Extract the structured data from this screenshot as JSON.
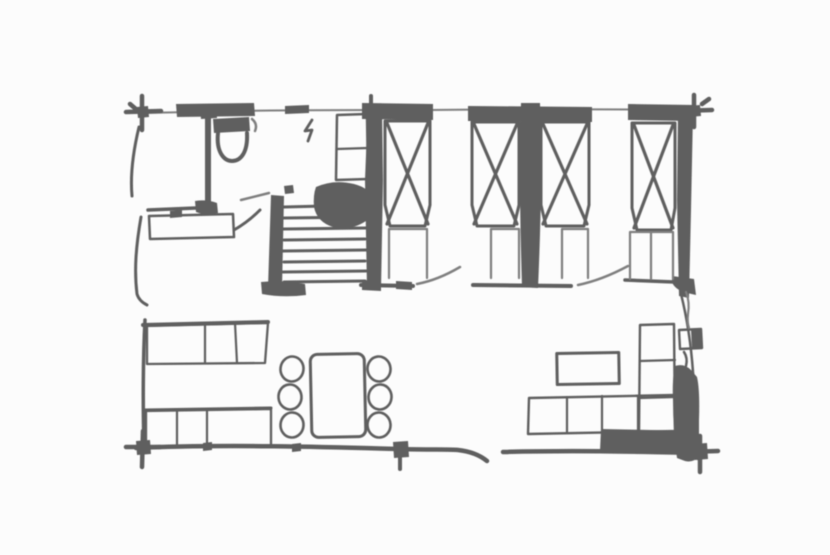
{
  "palette": {
    "ink": "#5e5e5e",
    "ink_lite": "#7f7f7f",
    "paper": "#fcfcfc"
  },
  "canvas": {
    "width": 830,
    "height": 555
  },
  "drawing": {
    "kind": "hand-drawn floor plan sketch",
    "text_labels": [],
    "rooms": [
      {
        "name": "bathroom",
        "position": "top-left"
      },
      {
        "name": "hall-and-stairs",
        "position": "top-center-left"
      },
      {
        "name": "sleeping-area",
        "position": "top-right",
        "beds": 4
      },
      {
        "name": "living-dining-area",
        "position": "bottom"
      }
    ],
    "furniture": [
      {
        "name": "toilet",
        "room": "bathroom"
      },
      {
        "name": "vanity-counter",
        "room": "bathroom"
      },
      {
        "name": "door-swing",
        "room": "bathroom"
      },
      {
        "name": "wardrobe",
        "room": "hall-and-stairs"
      },
      {
        "name": "staircase",
        "treads": 8
      },
      {
        "name": "landing-blob",
        "room": "hall-and-stairs"
      },
      {
        "name": "bed",
        "index": 1,
        "style": "x-cross-mattress"
      },
      {
        "name": "bed",
        "index": 2,
        "style": "x-cross-mattress"
      },
      {
        "name": "bed",
        "index": 3,
        "style": "x-cross-mattress"
      },
      {
        "name": "bed",
        "index": 4,
        "style": "x-cross-mattress"
      },
      {
        "name": "bench-seat",
        "index": 1,
        "sections": 3
      },
      {
        "name": "bench-seat",
        "index": 2,
        "sections": 3
      },
      {
        "name": "dining-table",
        "chairs": 6
      },
      {
        "name": "coffee-table"
      },
      {
        "name": "sectional-sofa",
        "sections": 4
      },
      {
        "name": "chaise-section",
        "sections": 3
      }
    ]
  }
}
